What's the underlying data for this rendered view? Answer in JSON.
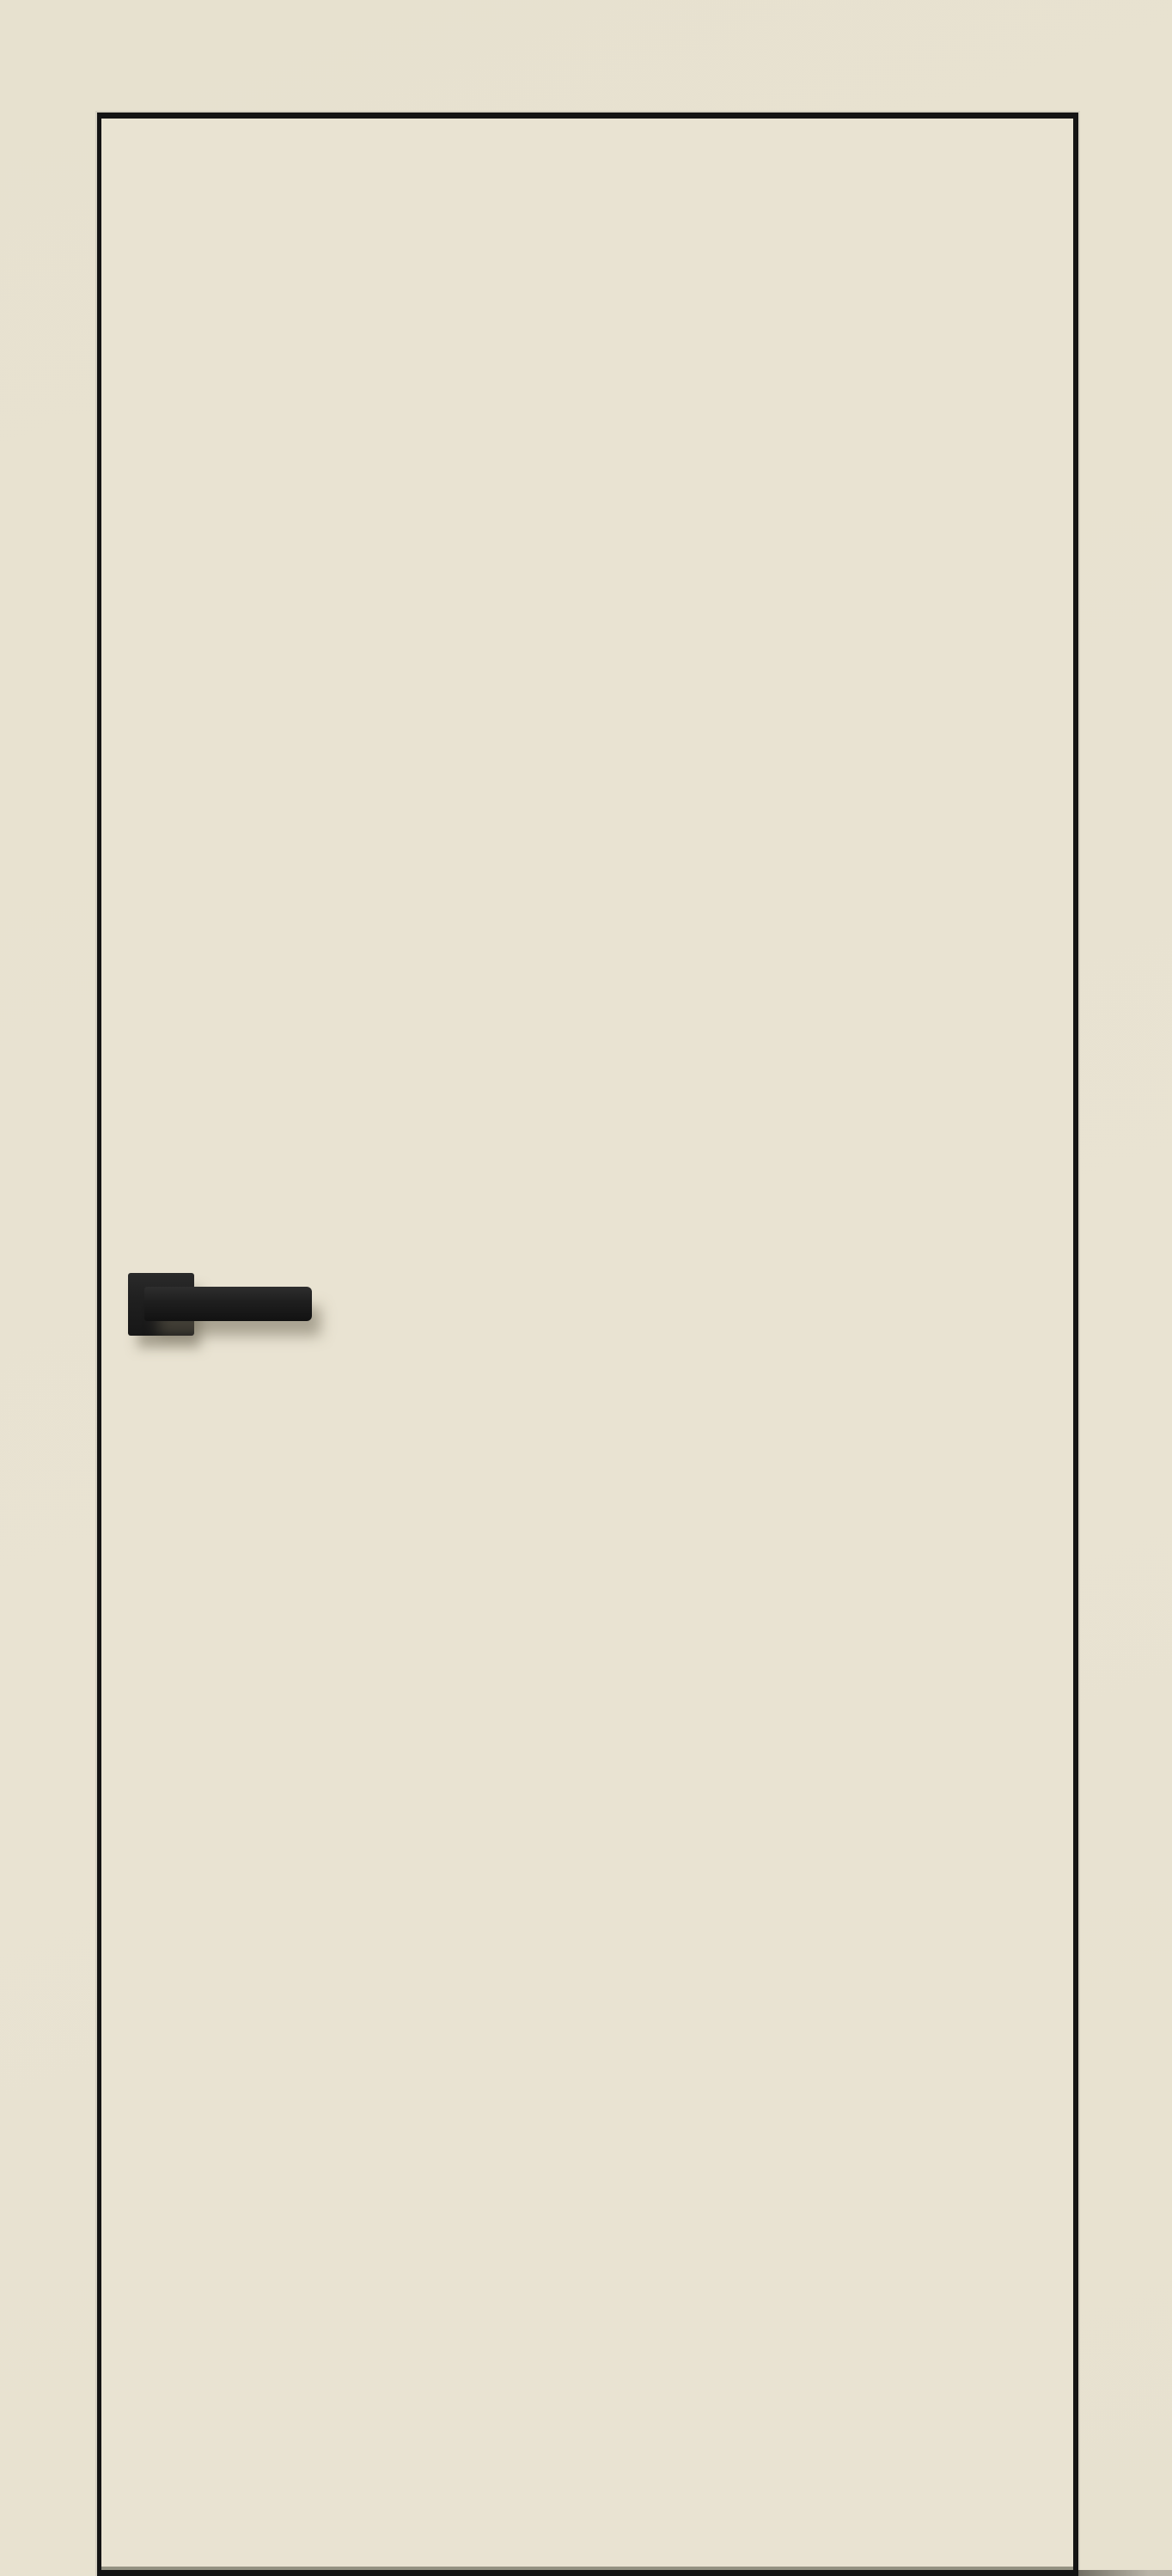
{
  "image": {
    "type": "product-photo",
    "subject": "interior door leaf, cream finish, black edge trim, black square-rosette lever handle, handle on left side"
  },
  "colors": {
    "bg": "#e7e1cf",
    "door-face": "#e9e3d2",
    "edge": "#141414",
    "halo": "rgba(205,201,186,0.7)",
    "floor-shadow": "#8b8879",
    "handle-top": "#2e2e2e",
    "handle-mid": "#1e1e1e",
    "handle-bottom": "#121212",
    "handle-shadow": "rgba(105,99,82,0.5)",
    "floor-strip-near": "#4a4840",
    "floor-strip-far": "#a8a499"
  }
}
